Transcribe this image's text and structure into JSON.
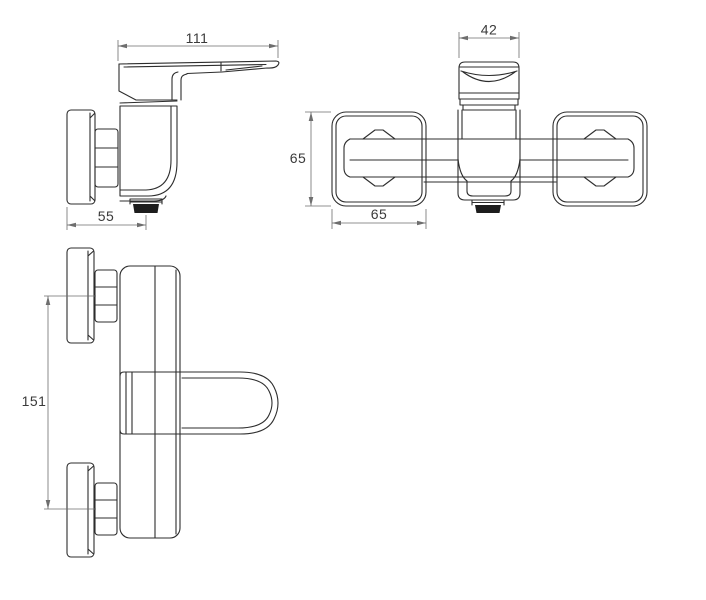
{
  "drawing": {
    "type": "technical-orthographic-drawing",
    "subject": "wall-mounted single-lever shower mixer faucet",
    "views": {
      "side": {
        "label_width": "111",
        "label_depth": "55"
      },
      "front": {
        "label_handle_width": "42",
        "label_escutcheon_height": "65",
        "label_escutcheon_width": "65"
      },
      "plan": {
        "label_connection_centers": "151"
      }
    },
    "colors": {
      "line": "#2d2d2d",
      "dimension": "#6e6e6e",
      "text": "#3a3a3a",
      "nozzle_fill": "#1d1d1d",
      "background": "#ffffff"
    }
  }
}
